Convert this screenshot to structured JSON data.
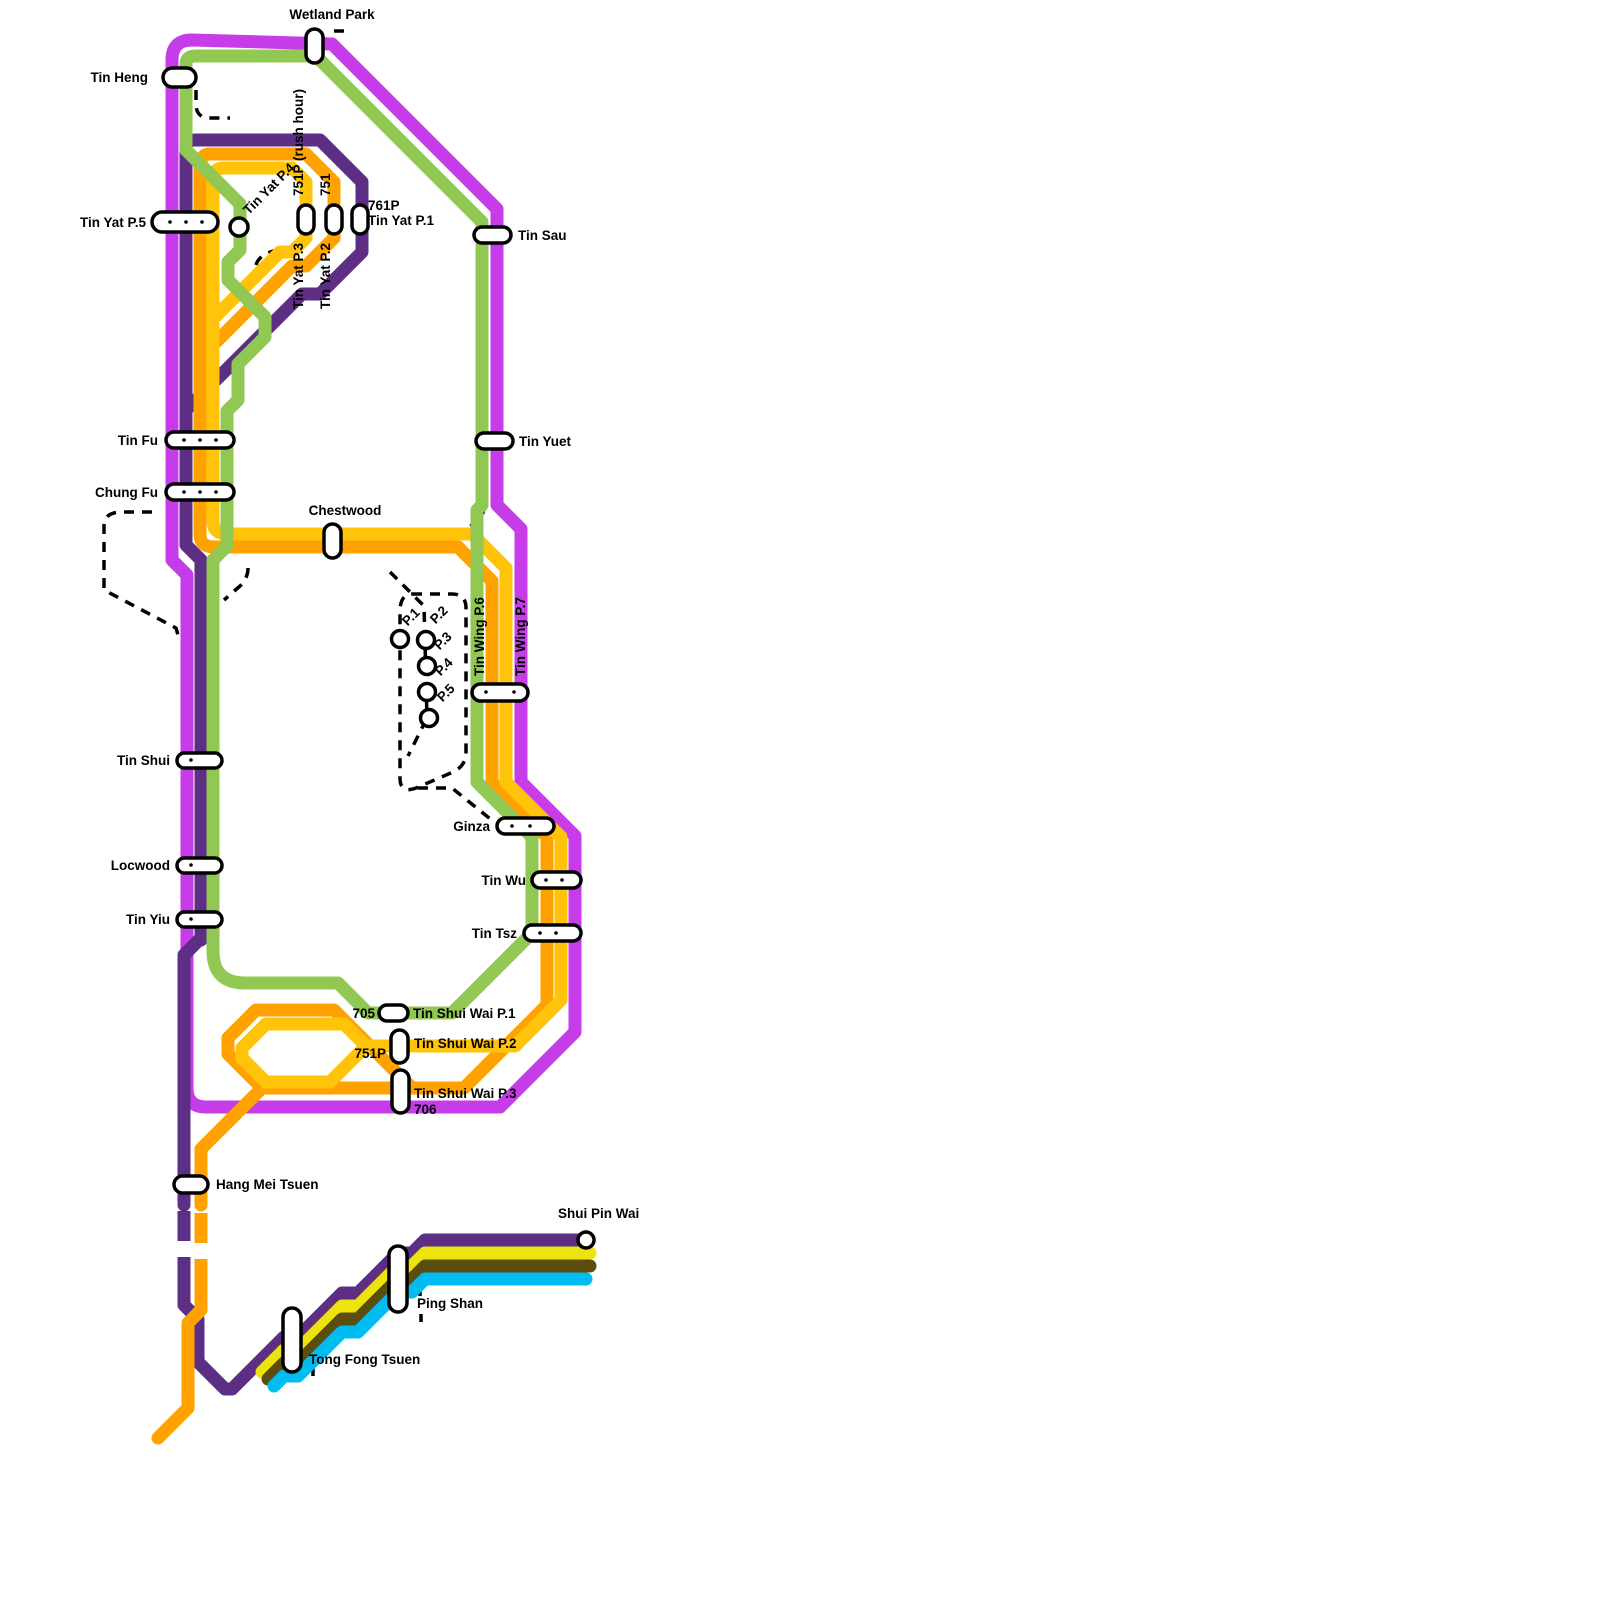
{
  "title": "Tin Shui Wai Light Rail network map",
  "colors": {
    "green_705": "#90C853",
    "magenta_706": "#C53CE8",
    "orange_751": "#FFA200",
    "amber_751p": "#FFC40A",
    "purple_761p": "#5C2E84",
    "yellow_615": "#EDE30E",
    "olive_610": "#5A4D0E",
    "cyan_614": "#00BCF0",
    "dashed_black": "#000000",
    "station_fill": "#FFFFFF",
    "station_stroke": "#000000"
  },
  "routes": {
    "r705": "705",
    "r706": "706",
    "r751": "751",
    "r751p": "751P",
    "r751p_rush": "751P (rush hour)",
    "r761p": "761P"
  },
  "stations": {
    "wetland_park": "Wetland Park",
    "tin_heng": "Tin Heng",
    "tin_yat_p5": "Tin Yat P.5",
    "tin_yat_p4": "Tin Yat P.4",
    "tin_yat_p3": "Tin Yat P.3",
    "tin_yat_p2": "Tin Yat P.2",
    "tin_yat_p1": "Tin Yat P.1",
    "tin_sau": "Tin Sau",
    "tin_yuet": "Tin Yuet",
    "tin_fu": "Tin Fu",
    "chung_fu": "Chung Fu",
    "chestwood": "Chestwood",
    "tin_wing_p6": "Tin Wing P.6",
    "tin_wing_p7": "Tin Wing P.7",
    "tin_shui": "Tin Shui",
    "ginza": "Ginza",
    "locwood": "Locwood",
    "tin_wu": "Tin Wu",
    "tin_yiu": "Tin Yiu",
    "tin_tsz": "Tin Tsz",
    "tsw_p1": "Tin Shui Wai P.1",
    "tsw_p2": "Tin Shui Wai P.2",
    "tsw_p3": "Tin Shui Wai P.3",
    "hang_mei_tsuen": "Hang Mei Tsuen",
    "shui_pin_wai": "Shui Pin Wai",
    "ping_shan": "Ping Shan",
    "tong_fong_tsuen": "Tong Fong Tsuen"
  },
  "platforms": {
    "p1": "P.1",
    "p2": "P.2",
    "p3": "P.3",
    "p4": "P.4",
    "p5": "P.5"
  }
}
